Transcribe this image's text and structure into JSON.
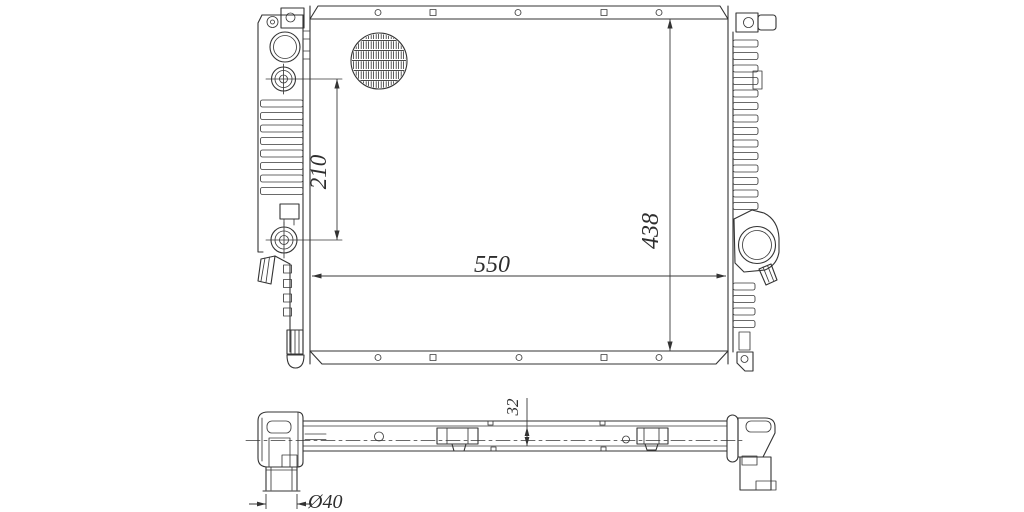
{
  "document": {
    "type": "technical-drawing",
    "subject": "automotive radiator",
    "background_color": "#ffffff",
    "line_color": "#333333",
    "views": [
      {
        "name": "front-view",
        "dimension_labels": [
          "210",
          "550",
          "438"
        ]
      },
      {
        "name": "bottom-view",
        "dimension_labels": [
          "32",
          "Ø40"
        ]
      }
    ]
  },
  "dimensions": {
    "d210": {
      "value": "210"
    },
    "d550": {
      "value": "550"
    },
    "d438": {
      "value": "438"
    },
    "d32": {
      "value": "32"
    },
    "d40": {
      "value": "Ø40"
    }
  }
}
